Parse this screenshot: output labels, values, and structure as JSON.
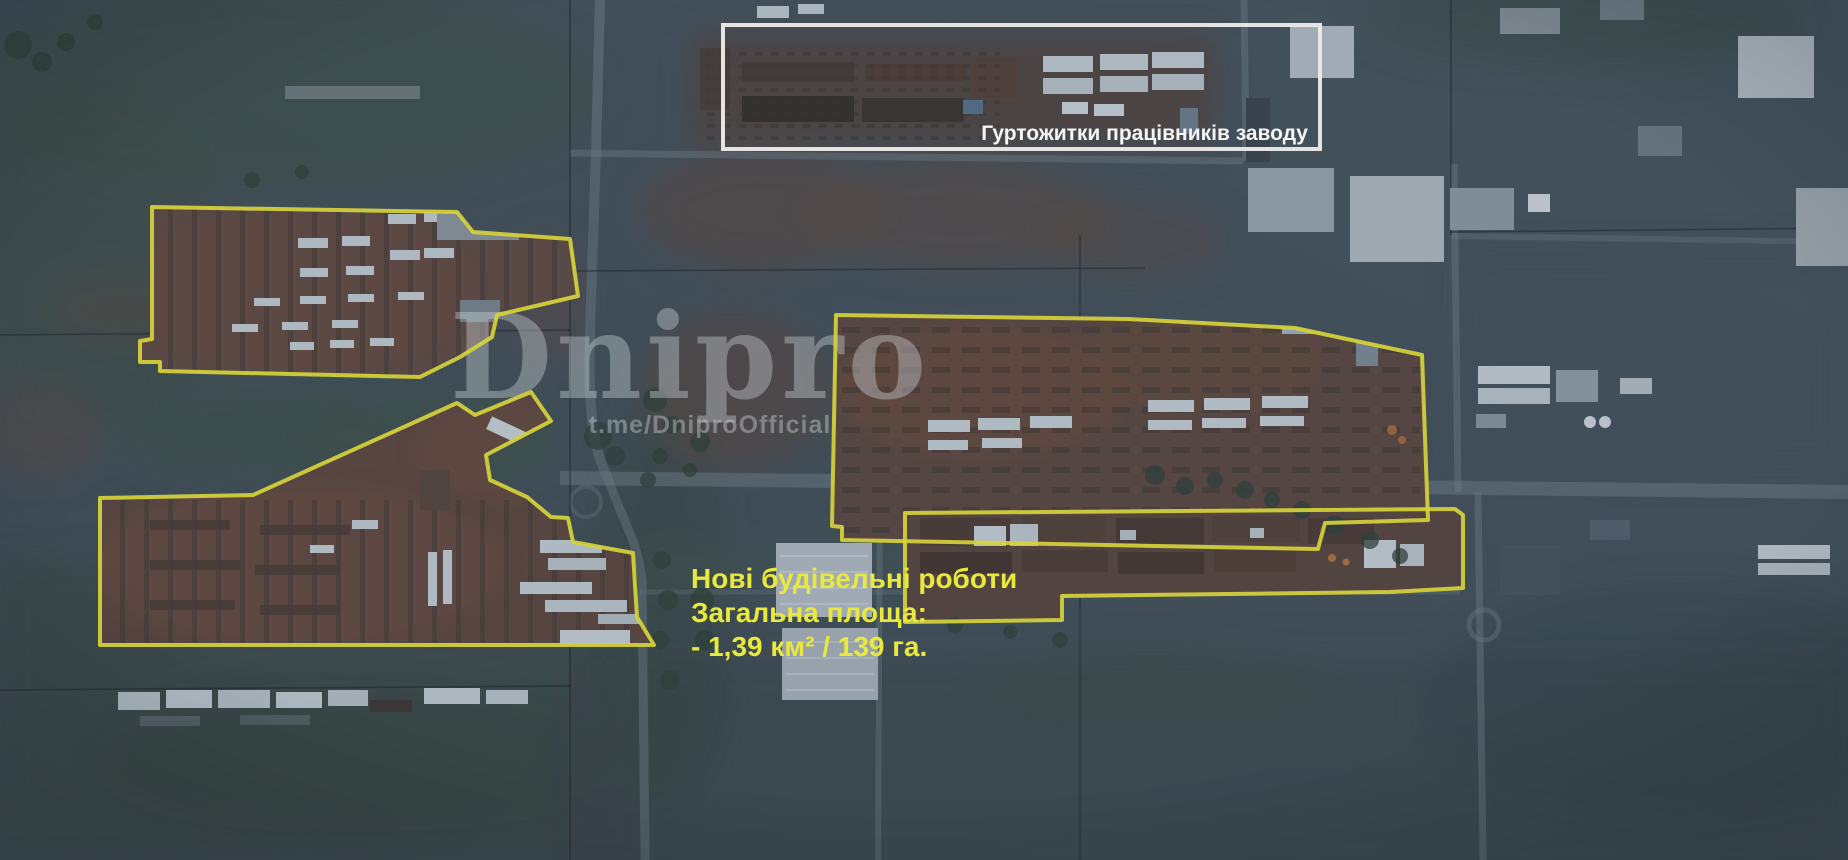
{
  "scene": {
    "type": "annotated-satellite-image",
    "description": "Satellite view of factory construction zone with marked construction sites"
  },
  "watermark": {
    "title": "Dnipro",
    "subtitle": "t.me/DniproOfficial"
  },
  "dormitory_box": {
    "label": "Гуртожитки працівників заводу"
  },
  "area_label": {
    "line1": "Нові будівельні роботи",
    "line2": "Загальна площа:",
    "line3": "- 1,39 км² / 139 га."
  },
  "colors": {
    "site_outline": "#d6d33b",
    "area_label_text": "#e9e93d",
    "callout_border": "#efede9",
    "callout_label": "#f3f5f7"
  },
  "sites": [
    {
      "name": "northwest-construction-site",
      "points": "152,207 457,212 473,232 570,239 578,296 497,315 492,337 460,357 420,377 160,371 160,362 140,362 140,341 152,339"
    },
    {
      "name": "west-construction-site",
      "points": "100,498 253,495 457,403 475,415 531,392 551,421 486,455 490,480 527,497 551,517 568,518 573,542 633,553 637,617 654,645 100,645"
    },
    {
      "name": "central-construction-site",
      "points": "836,315 1128,319 1295,328 1422,355 1428,520 1325,523 1318,549 842,540 842,527 832,526"
    },
    {
      "name": "southeast-construction-site",
      "points": "905,513 1455,509 1463,515 1463,588 1390,592 1062,596 1062,620 905,622"
    }
  ]
}
